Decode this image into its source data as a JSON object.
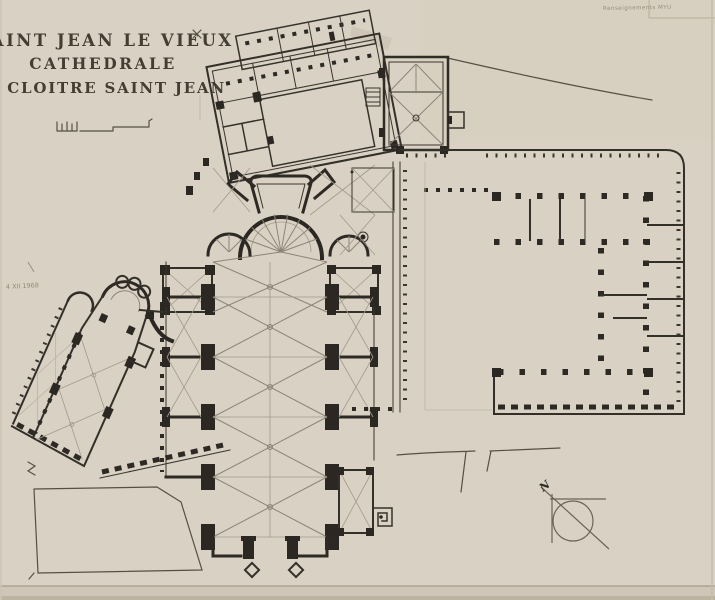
{
  "document": {
    "type": "architectural floor plan (hand-drawn survey)",
    "title_block": {
      "line1": "SAINT JEAN LE VIEUX",
      "line2": "CATHEDRALE",
      "line3": "ET CLOITRE SAINT JEAN"
    },
    "annotations": {
      "pencil_note_top_right": "Renseignements MYU",
      "date_note_left_margin": "4 XII 1968",
      "north_label": "N"
    },
    "colors": {
      "paper": "#d9d1c3",
      "ink": "#33302a",
      "rib_line": "#9d9386",
      "pencil_gray": "#948a78",
      "title_ink": "#453d33"
    }
  }
}
